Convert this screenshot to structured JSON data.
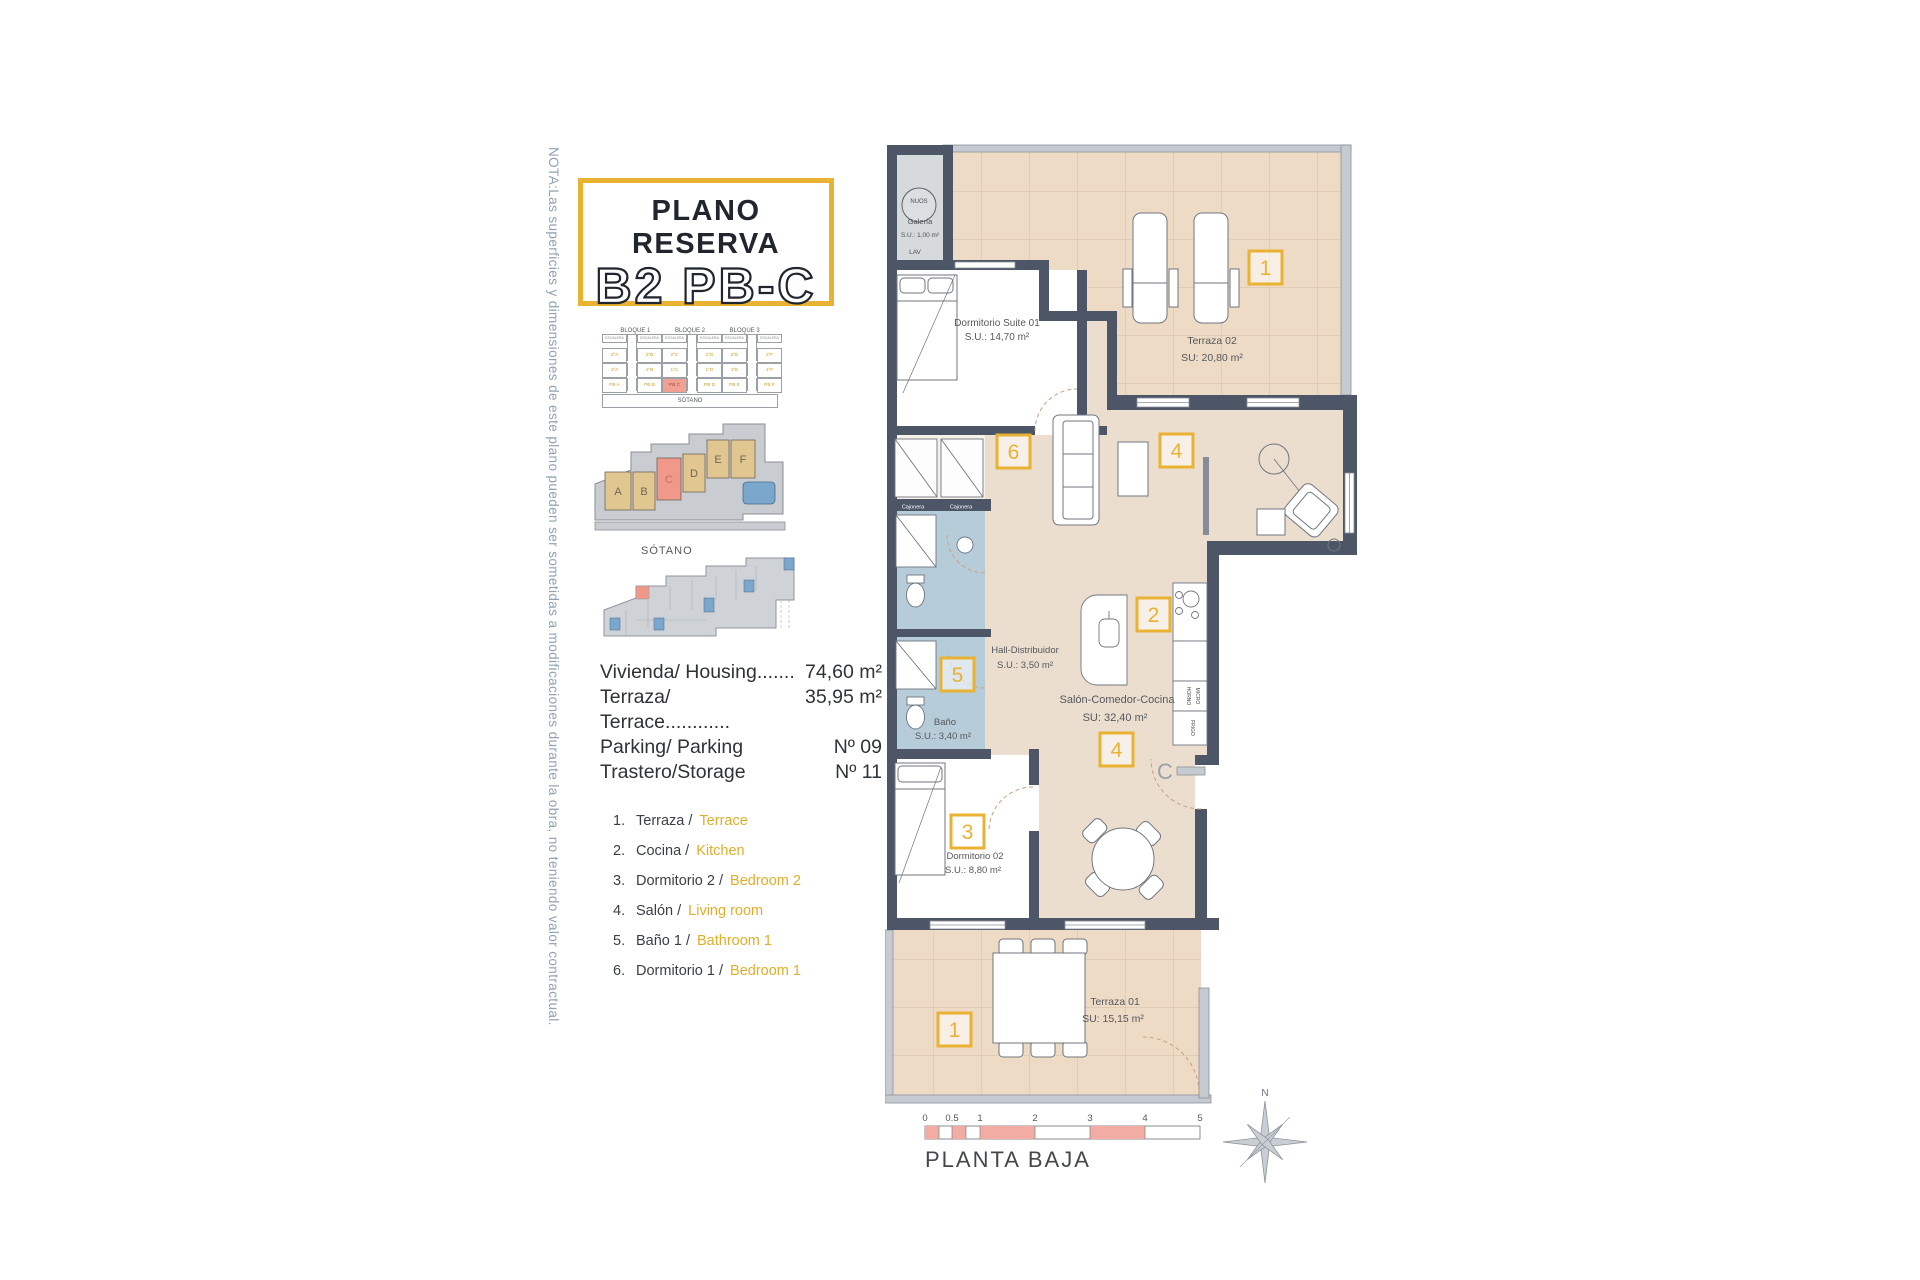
{
  "note": "NOTA:Las superficies y dimensiones de este plano pueden ser sometidas a modificaciones durante la obra, no teniendo valor contractual.",
  "title": {
    "line1": "PLANO RESERVA",
    "line2": "B2 PB-C"
  },
  "unit_grid": {
    "blocks": [
      "BLOQUE 1",
      "BLOQUE 2",
      "BLOQUE 3"
    ],
    "col_label": "ESCALERA",
    "rows": [
      [
        "2ºA",
        "2ºB",
        "2ºC",
        "2ºD",
        "2ºE",
        "2ºF"
      ],
      [
        "1ºA",
        "1ºB",
        "1ºC",
        "1ºD",
        "1ºE",
        "1ºF"
      ],
      [
        "PB A",
        "PB B",
        "PB C",
        "PB D",
        "PB E",
        "PB F"
      ]
    ],
    "footer": "SÓTANO"
  },
  "site_plan": {
    "units": [
      "A",
      "B",
      "C",
      "D",
      "E",
      "F"
    ]
  },
  "sotano": {
    "label": "SÓTANO"
  },
  "areas": [
    {
      "label": "Vivienda/ Housing.......",
      "value": "74,60 m²"
    },
    {
      "label": "Terraza/ Terrace............",
      "value": "35,95 m²"
    },
    {
      "label": "Parking/ Parking",
      "value": "Nº 09"
    },
    {
      "label": "Trastero/Storage",
      "value": "Nº 11"
    }
  ],
  "legend": [
    {
      "num": "1.",
      "es": "Terraza /",
      "en": "Terrace"
    },
    {
      "num": "2.",
      "es": "Cocina /",
      "en": "Kitchen"
    },
    {
      "num": "3.",
      "es": "Dormitorio 2 /",
      "en": "Bedroom 2"
    },
    {
      "num": "4.",
      "es": "Salón /",
      "en": "Living room"
    },
    {
      "num": "5.",
      "es": "Baño 1 /",
      "en": "Bathroom 1"
    },
    {
      "num": "6.",
      "es": "Dormitorio 1 /",
      "en": "Bedroom 1"
    }
  ],
  "plan": {
    "galeria": {
      "brand": "NUOS",
      "name": "Galería",
      "area": "S.U.: 1,00 m²",
      "lav": "LAV"
    },
    "suite": {
      "name": "Dormitorio Suite 01",
      "area": "S.U.: 14,70 m²"
    },
    "terraza2": {
      "name": "Terraza 02",
      "area": "SU: 20,80 m²"
    },
    "hall": {
      "name": "Hall-Distribuidor",
      "area": "S.U.: 3,50 m²"
    },
    "bano": {
      "name": "Baño",
      "area": "S.U.: 3,40 m²"
    },
    "salon": {
      "name": "Salón-Comedor-Cocina",
      "area": "SU: 32,40 m²"
    },
    "dorm2": {
      "name": "Dormitorio 02",
      "area": "S.U.: 8,80 m²"
    },
    "terraza1": {
      "name": "Terraza 01",
      "area": "SU: 15,15 m²"
    },
    "kitchen": {
      "horno": "HORNO",
      "micro": "MICRO",
      "frigo": "FRIGO"
    },
    "cajonera1": "Cajonera",
    "cajonera2": "Cajonera",
    "door_label": "C",
    "badges": {
      "terraza2": "1",
      "suite": "6",
      "living": "4",
      "cocina": "2",
      "bano": "5",
      "dorm2": "3",
      "comedor": "4",
      "terraza1": "1"
    },
    "scale_ticks": [
      "0",
      "0.5",
      "1",
      "2",
      "3",
      "4",
      "5"
    ],
    "floor_label": "PLANTA BAJA",
    "compass_n": "N"
  },
  "colors": {
    "accent": "#E9B233",
    "wall": "#4C5666",
    "terrace": "#EDDBC6",
    "interior": "#EBDECF",
    "bathroom": "#B7CCD9",
    "highlight": "#F0998A",
    "legend_en": "#DFAF2B",
    "scale_pink": "#F3ACA3"
  }
}
